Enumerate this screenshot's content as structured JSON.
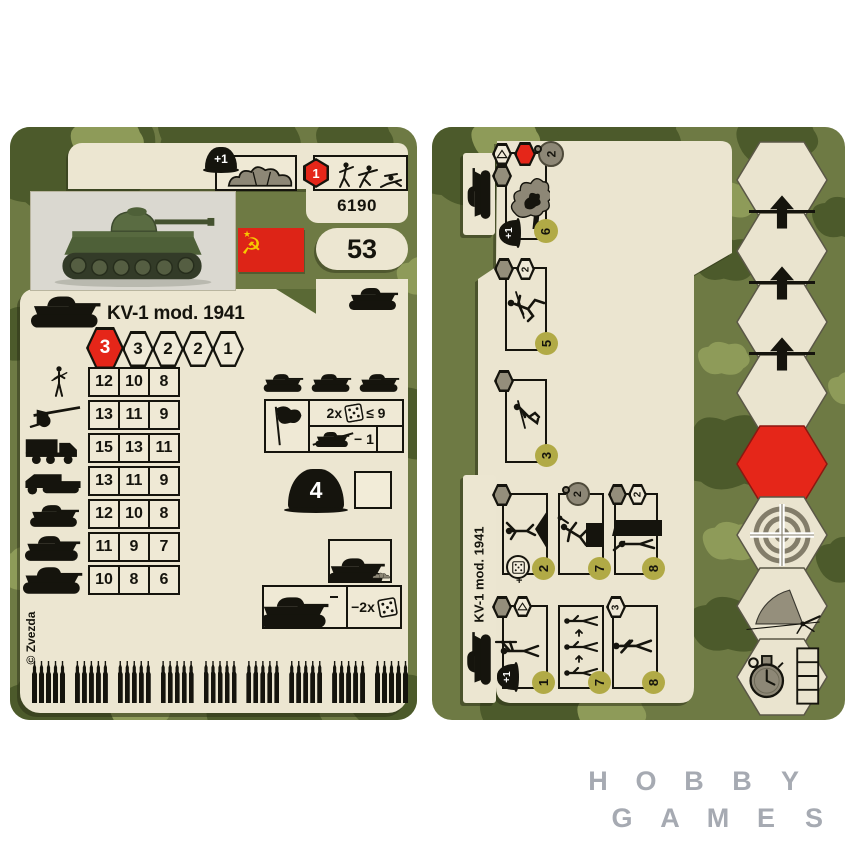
{
  "colors": {
    "camo_base": "#6e7a44",
    "camo_dark": "#4c5a2b",
    "camo_light": "#8e9b59",
    "cream": "#ece6d1",
    "accent_red": "#e52619",
    "order_circle": "#b1aa46",
    "ink": "#15140d",
    "watermark_gray": "#a6aab2"
  },
  "left_card": {
    "cover_bonus_label": "+1",
    "class_hex_value": "1",
    "product_code": "6190",
    "points": "53",
    "title": "KV-1 mod. 1941",
    "movement": [
      "3",
      "3",
      "2",
      "2",
      "1"
    ],
    "attack_rows": [
      {
        "icon": "infantry-icon",
        "values": [
          "12",
          "10",
          "8"
        ]
      },
      {
        "icon": "at-gun-icon",
        "values": [
          "13",
          "11",
          "9"
        ]
      },
      {
        "icon": "truck-icon",
        "values": [
          "15",
          "13",
          "11"
        ]
      },
      {
        "icon": "halftrack-icon",
        "values": [
          "13",
          "11",
          "9"
        ]
      },
      {
        "icon": "light-tank-icon",
        "values": [
          "12",
          "10",
          "8"
        ]
      },
      {
        "icon": "medium-tank-icon",
        "values": [
          "11",
          "9",
          "7"
        ]
      },
      {
        "icon": "heavy-tank-icon",
        "values": [
          "10",
          "8",
          "6"
        ]
      }
    ],
    "rally_rule": {
      "multiplier": "2x",
      "threshold": "≤ 9",
      "penalty": "− 1"
    },
    "armor": "4",
    "return_fire": "−2x",
    "copyright": "© Zvezda",
    "ammo": {
      "groups": 9,
      "per_group": 5
    }
  },
  "right_card": {
    "tab_title": "KV-1 mod. 1941",
    "boxes": [
      {
        "name": "smoke-screen",
        "order": "6",
        "bonus": "+1",
        "circle_badge": "2"
      },
      {
        "name": "sprint",
        "order": "5",
        "hex_badge": "2"
      },
      {
        "name": "crouch",
        "order": "3"
      },
      {
        "name": "climb",
        "order": "2",
        "die_bonus": "+"
      },
      {
        "name": "vault",
        "order": "7",
        "circle_badge": "2"
      },
      {
        "name": "take-cover",
        "order": "8",
        "hex_badge": "2"
      },
      {
        "name": "aim",
        "order": "1",
        "bonus": "+1"
      },
      {
        "name": "march",
        "order": "7"
      },
      {
        "name": "walk",
        "order": "8",
        "hex_badge": "3"
      }
    ],
    "hex_track": [
      "blank",
      "advance",
      "advance",
      "advance",
      "halt",
      "target",
      "arc-fire",
      "timer"
    ]
  },
  "watermark": {
    "row1": [
      "H",
      "O",
      "B",
      "B",
      "Y"
    ],
    "row2": [
      "G",
      "A",
      "M",
      "E",
      "S"
    ]
  }
}
